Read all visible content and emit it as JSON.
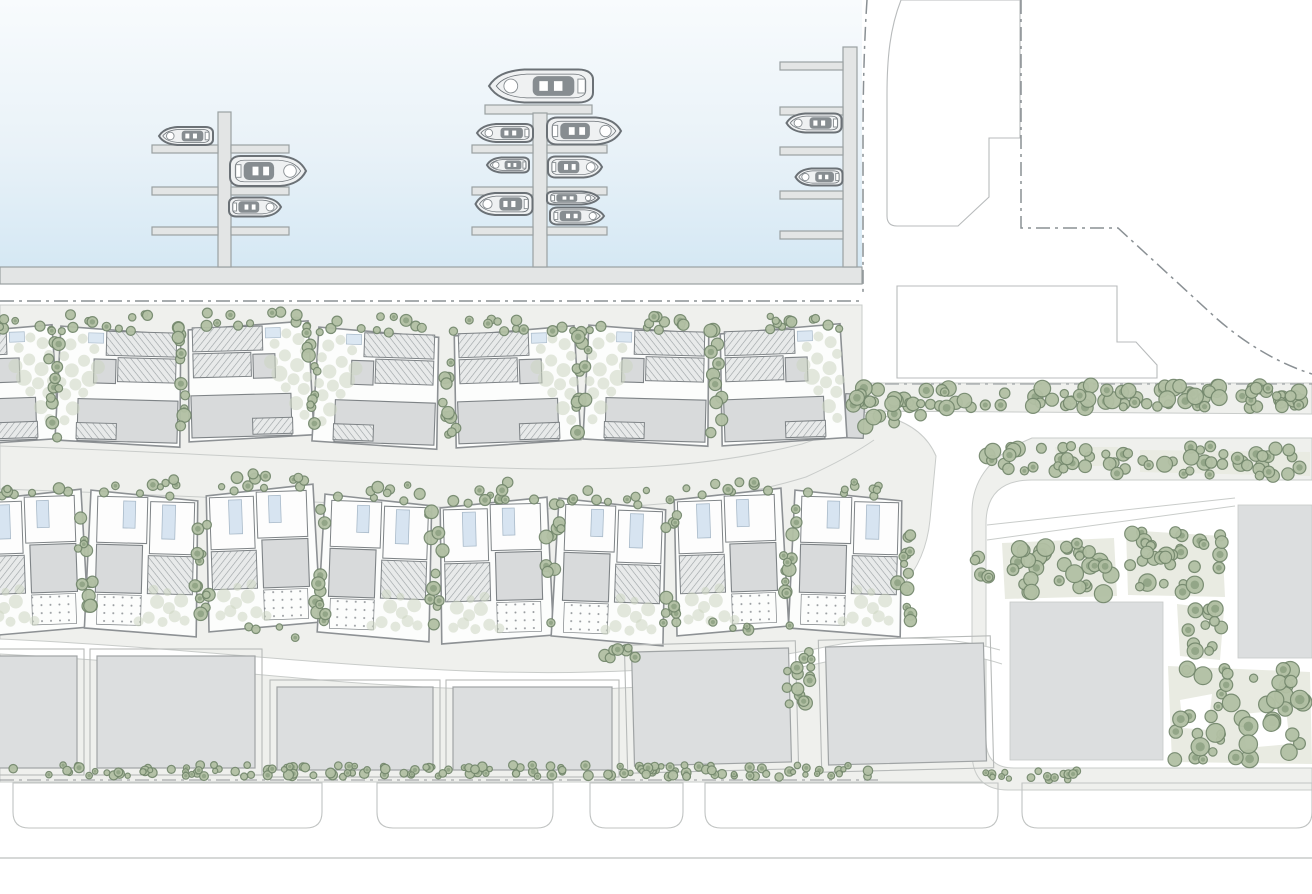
{
  "scene": {
    "type": "architectural-site-plan",
    "description": "Masterplan plan-view of a marina-front residential development: harbour basin with piers and moored boats at top, two rows of villa plots with gardens, a row of slab apartment buildings, a landscaped eastern parcel, boundary dash-dot lines and a promenade at the bottom. No text labels are visible in the drawing.",
    "visible_text": "none"
  },
  "palette": {
    "water_top": "#f8fbfd",
    "water_mid": "#e9f2f8",
    "water_bottom": "#d5e8f4",
    "dock_fill": "#e3e5e5",
    "dock_stroke": "#9aa0a2",
    "boat_fill": "#eff1f2",
    "boat_stroke": "#6b7176",
    "boat_detail": "#878d91",
    "boundary": "#8a9094",
    "site_gray": "#eff0ed",
    "road_edge": "#c9ccca",
    "parcel_stroke": "#b8bbbc",
    "plot_outline": "#8d9194",
    "building_fill": "#d8dadb",
    "building_stroke": "#7e8386",
    "hatch_bg": "#e8eaea",
    "hatch_line": "#9aa0a3",
    "pool_fill": "#d7e4f1",
    "pool_stroke": "#a9bac9",
    "slab_fill": "#dcdedf",
    "slab_stroke": "#a0a4a5",
    "frame_stroke": "#b7bab9",
    "beige": "#e9ebe2",
    "tree_dark_fill": "#b2c0a4",
    "tree_dark_stroke": "#75896e",
    "tree_dark_core": "#8da182",
    "tree_light": "#ccd6c1",
    "bottom_stroke": "#c0c3c2"
  },
  "counts": {
    "piers": 3,
    "finger_docks": 17,
    "boats": 13,
    "villa_plots_row1": 7,
    "villa_plots_row2": 8,
    "slab_buildings": 6,
    "east_parcel_buildings": 2,
    "promenade_bays": 5
  },
  "marina": {
    "dock_format": "[x,y,w,h]",
    "docks": [
      [
        0,
        267,
        862,
        17
      ],
      [
        843,
        47,
        14,
        220
      ],
      [
        218,
        112,
        13,
        155
      ],
      [
        152,
        145,
        66,
        8
      ],
      [
        231,
        145,
        58,
        8
      ],
      [
        152,
        187,
        66,
        8
      ],
      [
        231,
        187,
        58,
        8
      ],
      [
        152,
        227,
        66,
        8
      ],
      [
        231,
        227,
        58,
        8
      ],
      [
        485,
        105,
        107,
        9
      ],
      [
        533,
        113,
        14,
        154
      ],
      [
        472,
        145,
        61,
        8
      ],
      [
        472,
        187,
        61,
        8
      ],
      [
        472,
        227,
        61,
        8
      ],
      [
        547,
        145,
        60,
        8
      ],
      [
        547,
        187,
        60,
        8
      ],
      [
        547,
        227,
        60,
        8
      ],
      [
        780,
        62,
        63,
        8
      ],
      [
        780,
        107,
        63,
        8
      ],
      [
        780,
        147,
        63,
        8
      ],
      [
        780,
        191,
        63,
        8
      ],
      [
        780,
        231,
        63,
        8
      ]
    ],
    "boat_format": "[cx,cy,length,beam,flipped(bow-right)]",
    "boats": [
      [
        186,
        136,
        54,
        18,
        0
      ],
      [
        268,
        171,
        76,
        30,
        1
      ],
      [
        255,
        207,
        52,
        19,
        1
      ],
      [
        505,
        133,
        56,
        18,
        0
      ],
      [
        508,
        165,
        42,
        15,
        0
      ],
      [
        504,
        204,
        57,
        22,
        0
      ],
      [
        541,
        86,
        104,
        33,
        0
      ],
      [
        584,
        131,
        74,
        27,
        1
      ],
      [
        575,
        167,
        54,
        21,
        1
      ],
      [
        573,
        198,
        52,
        13,
        1
      ],
      [
        577,
        216,
        54,
        17,
        1
      ],
      [
        814,
        123,
        55,
        19,
        0
      ],
      [
        819,
        177,
        47,
        17,
        0
      ]
    ]
  },
  "development": {
    "villa_row_1": {
      "plot_size": [
        125,
        120
      ],
      "plot_format": "[x,y,rot,flip]",
      "plots": [
        [
          -70,
          327,
          -2,
          0
        ],
        [
          58,
          324,
          1.5,
          1
        ],
        [
          186,
          322,
          -1.5,
          0
        ],
        [
          316,
          325,
          2,
          1
        ],
        [
          452,
          328,
          -2,
          0
        ],
        [
          586,
          323,
          1.5,
          1
        ],
        [
          718,
          326,
          -2,
          0
        ]
      ]
    },
    "villa_row_2": {
      "plot_size": [
        112,
        144
      ],
      "plot_format": "[x,y,rot,flip]",
      "plots": [
        [
          -28,
          493,
          -2,
          0
        ],
        [
          88,
          490,
          1.5,
          1
        ],
        [
          204,
          488,
          -2,
          0
        ],
        [
          322,
          494,
          2,
          1
        ],
        [
          438,
          500,
          -1.5,
          0
        ],
        [
          556,
          498,
          2,
          1
        ],
        [
          672,
          492,
          -2,
          0
        ],
        [
          792,
          490,
          1.5,
          1
        ]
      ]
    },
    "slab_format": "[x,y,w,h,rot]",
    "slabs": [
      [
        -78,
        656,
        155,
        112,
        0
      ],
      [
        97,
        656,
        158,
        112,
        0
      ],
      [
        277,
        687,
        156,
        83,
        0
      ],
      [
        453,
        687,
        159,
        83,
        0
      ],
      [
        633,
        650,
        157,
        114,
        -1.5
      ],
      [
        827,
        645,
        158,
        118,
        -1.5
      ]
    ],
    "east_parcel": {
      "square_format": "[x,y,w,h]",
      "squares": [
        [
          1010,
          602,
          153,
          158
        ],
        [
          1238,
          505,
          74,
          153
        ]
      ],
      "patches": [
        {
          "fill": "beige",
          "pts": [
            [
              1002,
              543
            ],
            [
              1114,
              538
            ],
            [
              1117,
              596
            ],
            [
              1005,
              599
            ]
          ]
        },
        {
          "fill": "beige",
          "pts": [
            [
              1126,
              530
            ],
            [
              1222,
              536
            ],
            [
              1225,
              597
            ],
            [
              1128,
              595
            ]
          ]
        },
        {
          "fill": "beige",
          "pts": [
            [
              1177,
              604
            ],
            [
              1224,
              610
            ],
            [
              1220,
              660
            ],
            [
              1180,
              656
            ]
          ]
        },
        {
          "fill": "beige",
          "pts": [
            [
              1168,
              666
            ],
            [
              1310,
              672
            ],
            [
              1312,
              764
            ],
            [
              1172,
              762
            ]
          ]
        },
        {
          "fill": "white",
          "pts": [
            [
              1180,
              700
            ],
            [
              1212,
              694
            ],
            [
              1208,
              730
            ],
            [
              1183,
              728
            ]
          ]
        },
        {
          "fill": "white",
          "pts": [
            [
              1242,
              714
            ],
            [
              1286,
              710
            ],
            [
              1290,
              744
            ],
            [
              1246,
              748
            ]
          ]
        },
        {
          "fill": "beige",
          "pts": [
            [
              1055,
              447
            ],
            [
              1118,
              447
            ],
            [
              1114,
              466
            ],
            [
              1058,
              466
            ]
          ]
        },
        {
          "fill": "beige",
          "pts": [
            [
              1140,
              450
            ],
            [
              1310,
              452
            ],
            [
              1310,
              476
            ],
            [
              1140,
              472
            ]
          ]
        }
      ]
    },
    "promenade_bays": {
      "y": 783,
      "h": 45,
      "corner": 16,
      "x_w": [
        [
          13,
          309
        ],
        [
          377,
          176
        ],
        [
          590,
          93
        ],
        [
          705,
          293
        ],
        [
          1022,
          290
        ]
      ]
    }
  },
  "vegetation": {
    "cluster_format": "[x,y,w,h,count,rmin,rmax,tone,seed]",
    "clusters": [
      [
        46,
        328,
        15,
        112,
        12,
        3.5,
        7,
        "d",
        11
      ],
      [
        176,
        326,
        15,
        112,
        12,
        3.5,
        7,
        "d",
        12
      ],
      [
        306,
        326,
        15,
        112,
        12,
        3.5,
        7,
        "d",
        13
      ],
      [
        442,
        330,
        15,
        112,
        12,
        3.5,
        7,
        "d",
        14
      ],
      [
        576,
        326,
        15,
        112,
        12,
        3.5,
        7,
        "d",
        15
      ],
      [
        708,
        328,
        15,
        112,
        12,
        3.5,
        7,
        "d",
        16
      ],
      [
        -40,
        316,
        90,
        14,
        6,
        3,
        6,
        "d",
        21
      ],
      [
        70,
        314,
        100,
        14,
        7,
        3,
        6,
        "d",
        22
      ],
      [
        198,
        312,
        100,
        14,
        7,
        3,
        6,
        "d",
        23
      ],
      [
        328,
        315,
        100,
        14,
        7,
        3,
        6,
        "d",
        24
      ],
      [
        464,
        318,
        100,
        14,
        7,
        3,
        6,
        "d",
        25
      ],
      [
        598,
        313,
        100,
        14,
        7,
        3,
        6,
        "d",
        26
      ],
      [
        730,
        316,
        100,
        14,
        7,
        3,
        6,
        "d",
        27
      ],
      [
        78,
        494,
        15,
        134,
        12,
        3.5,
        7,
        "d",
        31
      ],
      [
        194,
        492,
        15,
        134,
        12,
        3.5,
        7,
        "d",
        32
      ],
      [
        312,
        492,
        15,
        134,
        12,
        3.5,
        7,
        "d",
        33
      ],
      [
        428,
        496,
        15,
        134,
        12,
        3.5,
        7,
        "d",
        34
      ],
      [
        546,
        498,
        15,
        134,
        12,
        3.5,
        7,
        "d",
        35
      ],
      [
        662,
        496,
        15,
        134,
        12,
        3.5,
        7,
        "d",
        36
      ],
      [
        782,
        492,
        15,
        134,
        12,
        3.5,
        7,
        "d",
        37
      ],
      [
        896,
        490,
        15,
        138,
        13,
        3.5,
        7,
        "d",
        38
      ],
      [
        -16,
        482,
        88,
        13,
        6,
        3,
        6,
        "d",
        41
      ],
      [
        100,
        479,
        88,
        13,
        6,
        3,
        6,
        "d",
        42
      ],
      [
        216,
        477,
        88,
        13,
        6,
        3,
        6,
        "d",
        43
      ],
      [
        334,
        483,
        88,
        13,
        6,
        3,
        6,
        "d",
        44
      ],
      [
        450,
        489,
        88,
        13,
        6,
        3,
        6,
        "d",
        45
      ],
      [
        568,
        487,
        88,
        13,
        6,
        3,
        6,
        "d",
        46
      ],
      [
        684,
        481,
        88,
        13,
        6,
        3,
        6,
        "d",
        47
      ],
      [
        804,
        479,
        88,
        13,
        6,
        3,
        6,
        "d",
        48
      ],
      [
        240,
        626,
        60,
        12,
        4,
        3,
        5.5,
        "d",
        51
      ],
      [
        700,
        622,
        60,
        12,
        4,
        3,
        5.5,
        "d",
        52
      ],
      [
        858,
        385,
        452,
        23,
        85,
        4,
        8.5,
        "d",
        61
      ],
      [
        850,
        396,
        72,
        32,
        18,
        4,
        8,
        "d",
        62
      ],
      [
        985,
        446,
        325,
        20,
        42,
        4,
        8,
        "d",
        63
      ],
      [
        990,
        464,
        318,
        12,
        20,
        4,
        7,
        "d",
        64
      ],
      [
        1006,
        542,
        108,
        52,
        32,
        4,
        9,
        "d",
        65
      ],
      [
        1128,
        532,
        94,
        60,
        32,
        4,
        9,
        "d",
        66
      ],
      [
        1180,
        606,
        42,
        50,
        13,
        4,
        8,
        "d",
        67
      ],
      [
        1172,
        668,
        136,
        92,
        46,
        4,
        9.5,
        "d",
        68
      ],
      [
        2,
        765,
        876,
        12,
        150,
        2.5,
        5,
        "d",
        71
      ],
      [
        985,
        771,
        95,
        9,
        16,
        2.5,
        4.5,
        "d",
        72
      ],
      [
        786,
        648,
        26,
        62,
        16,
        3.5,
        7,
        "d",
        73
      ],
      [
        598,
        646,
        46,
        13,
        8,
        3,
        6,
        "d",
        74
      ],
      [
        974,
        556,
        18,
        30,
        5,
        3.5,
        6.5,
        "d",
        75
      ],
      [
        246,
        470,
        20,
        12,
        3,
        3.5,
        6,
        "d",
        76
      ],
      [
        500,
        482,
        18,
        10,
        2,
        3.5,
        6,
        "d",
        77
      ]
    ]
  }
}
